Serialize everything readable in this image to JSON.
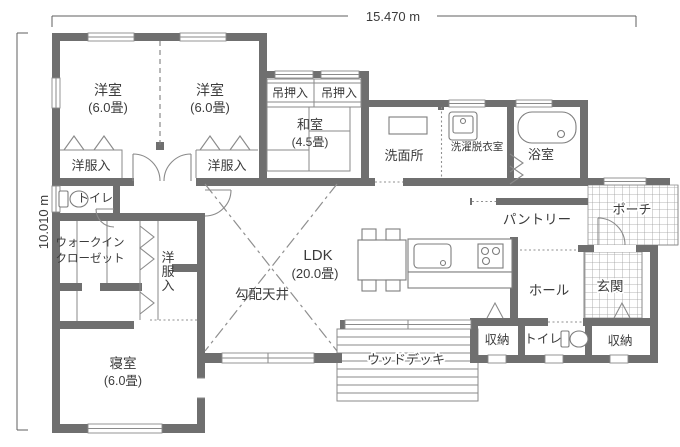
{
  "dimension_labels": {
    "width": "15.470 m",
    "height": "10.010 m"
  },
  "rooms": {
    "western_room_1": {
      "name": "洋室",
      "size": "(6.0畳)"
    },
    "western_room_2": {
      "name": "洋室",
      "size": "(6.0畳)"
    },
    "closet_1": {
      "name": "洋服入"
    },
    "closet_2": {
      "name": "洋服入"
    },
    "hanging_closet_1": {
      "name": "吊押入"
    },
    "hanging_closet_2": {
      "name": "吊押入"
    },
    "japanese_room": {
      "name": "和室",
      "size": "(4.5畳)"
    },
    "washroom": {
      "name": "洗面所"
    },
    "laundry_room": {
      "name": "洗濯脱衣室"
    },
    "bathroom": {
      "name": "浴室"
    },
    "toilet_1": {
      "name": "トイレ"
    },
    "walk_in_closet": {
      "name_line1": "ウォークイン",
      "name_line2": "クローゼット"
    },
    "closet_3": {
      "name": "洋服入"
    },
    "bedroom": {
      "name": "寝室",
      "size": "(6.0畳)"
    },
    "ldk": {
      "name": "LDK",
      "size": "(20.0畳)"
    },
    "sloped_ceiling": {
      "name": "勾配天井"
    },
    "pantry": {
      "name": "パントリー"
    },
    "porch": {
      "name": "ポーチ"
    },
    "hall": {
      "name": "ホール"
    },
    "entrance": {
      "name": "玄関"
    },
    "storage_1": {
      "name": "収納"
    },
    "toilet_2": {
      "name": "トイレ"
    },
    "storage_2": {
      "name": "収納"
    },
    "wood_deck": {
      "name": "ウッドデッキ"
    }
  },
  "colors": {
    "wall": "#6f6f6f",
    "line": "#8a8a8a",
    "text": "#3b3b3b",
    "background": "#ffffff"
  }
}
